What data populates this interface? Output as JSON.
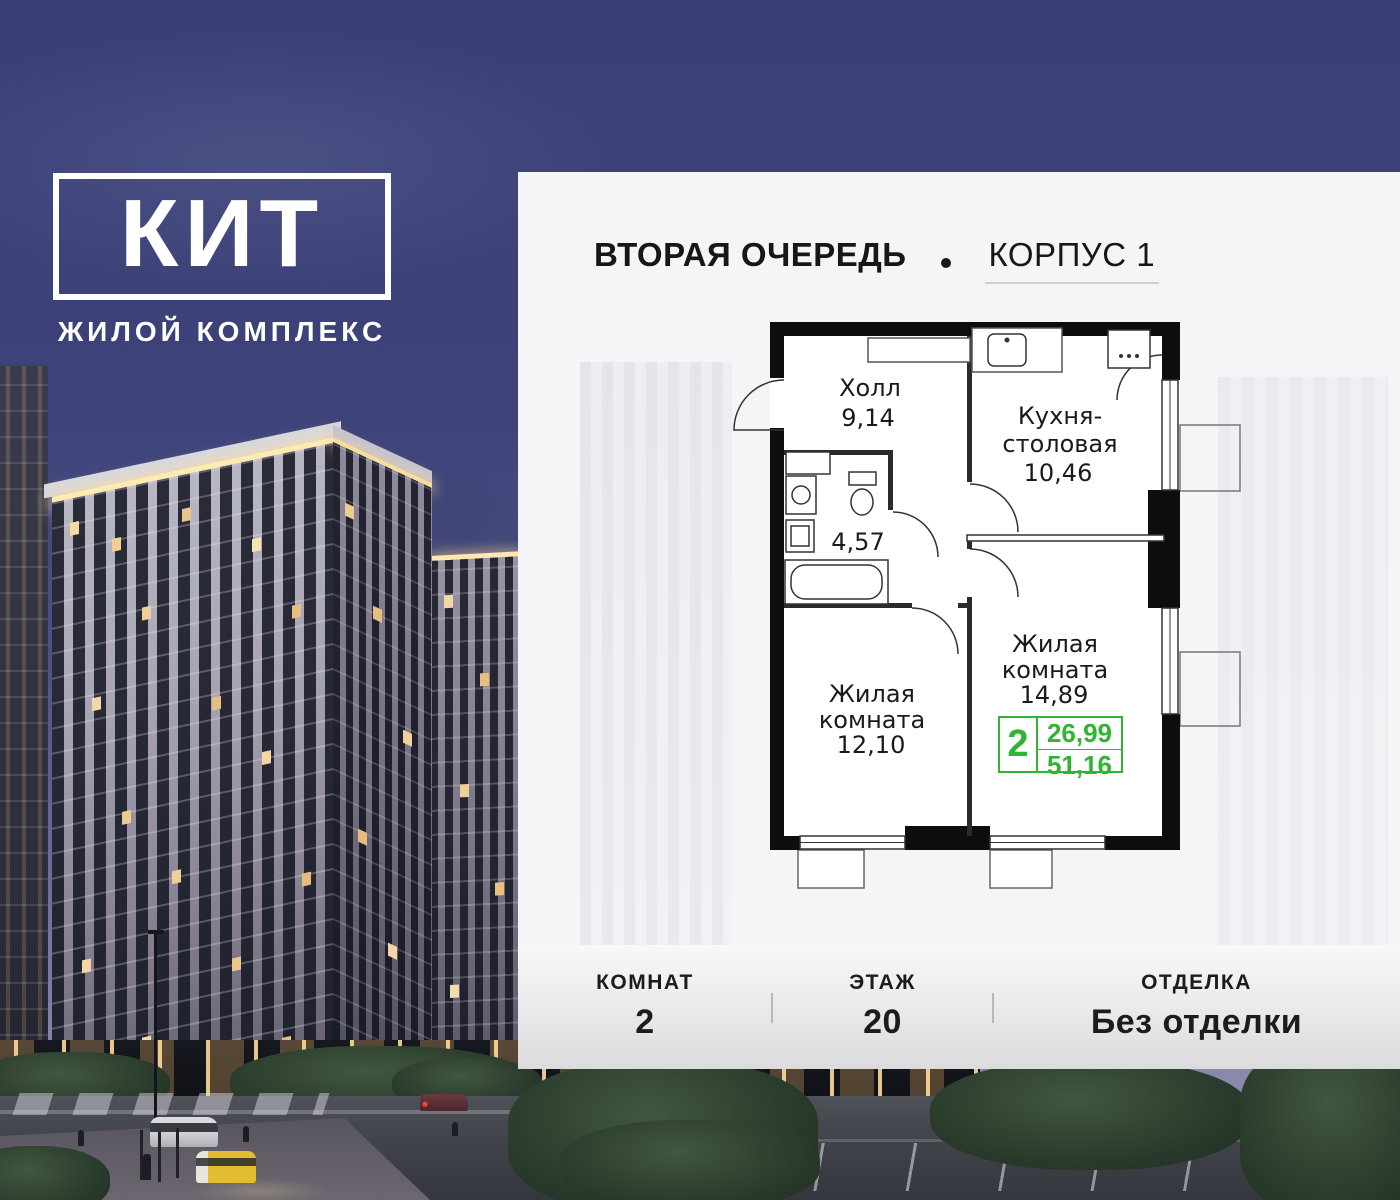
{
  "brand": {
    "logo": "КИТ",
    "subtitle": "ЖИЛОЙ КОМПЛЕКС"
  },
  "header": {
    "phase": "ВТОРАЯ ОЧЕРЕДЬ",
    "building": "КОРПУС 1"
  },
  "plan": {
    "hall": {
      "name": "Холл",
      "area": "9,14"
    },
    "kitchen": {
      "line1": "Кухня-",
      "line2": "столовая",
      "area": "10,46"
    },
    "bath": {
      "area": "4,57"
    },
    "living_small": {
      "line1": "Жилая",
      "line2": "комната",
      "area": "12,10"
    },
    "living_large": {
      "line1": "Жилая",
      "line2": "комната",
      "area": "14,89"
    }
  },
  "summary": {
    "rooms": "2",
    "living_area": "26,99",
    "total_area": "51,16"
  },
  "details": {
    "items": [
      {
        "label": "КОМНАТ",
        "value": "2"
      },
      {
        "label": "ЭТАЖ",
        "value": "20"
      },
      {
        "label": "ОТДЕЛКА",
        "value": "Без отделки"
      }
    ]
  },
  "colors": {
    "accent_green": "#2fb52f",
    "sky": "#3a4077",
    "panel": "#f5f5f8",
    "wall": "#0d0d0d",
    "text": "#1a1a1a"
  }
}
